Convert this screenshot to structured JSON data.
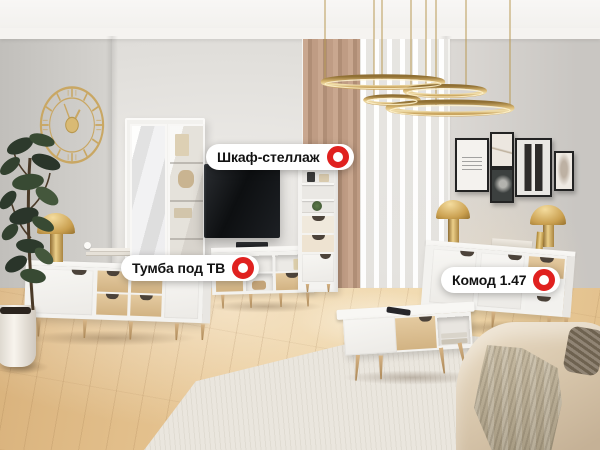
{
  "scene": {
    "type": "living-room-furniture-showroom-photo",
    "description": "Living room with white/oak furniture set, gold decor and product hotspot tags"
  },
  "hotspots": [
    {
      "label": "Шкаф-стеллаж"
    },
    {
      "label": "Тумба под ТВ"
    },
    {
      "label": "Комод 1.47"
    }
  ],
  "colors": {
    "accent": "#e0211f",
    "label_bg": "#ffffff",
    "label_text": "#121212",
    "gold": "#c8a258",
    "wood": "#d9bc8e",
    "wall": "#e2e0dc",
    "floor": "#e4c292",
    "sofa": "#d7c5aa",
    "rug": "#eae6de"
  }
}
